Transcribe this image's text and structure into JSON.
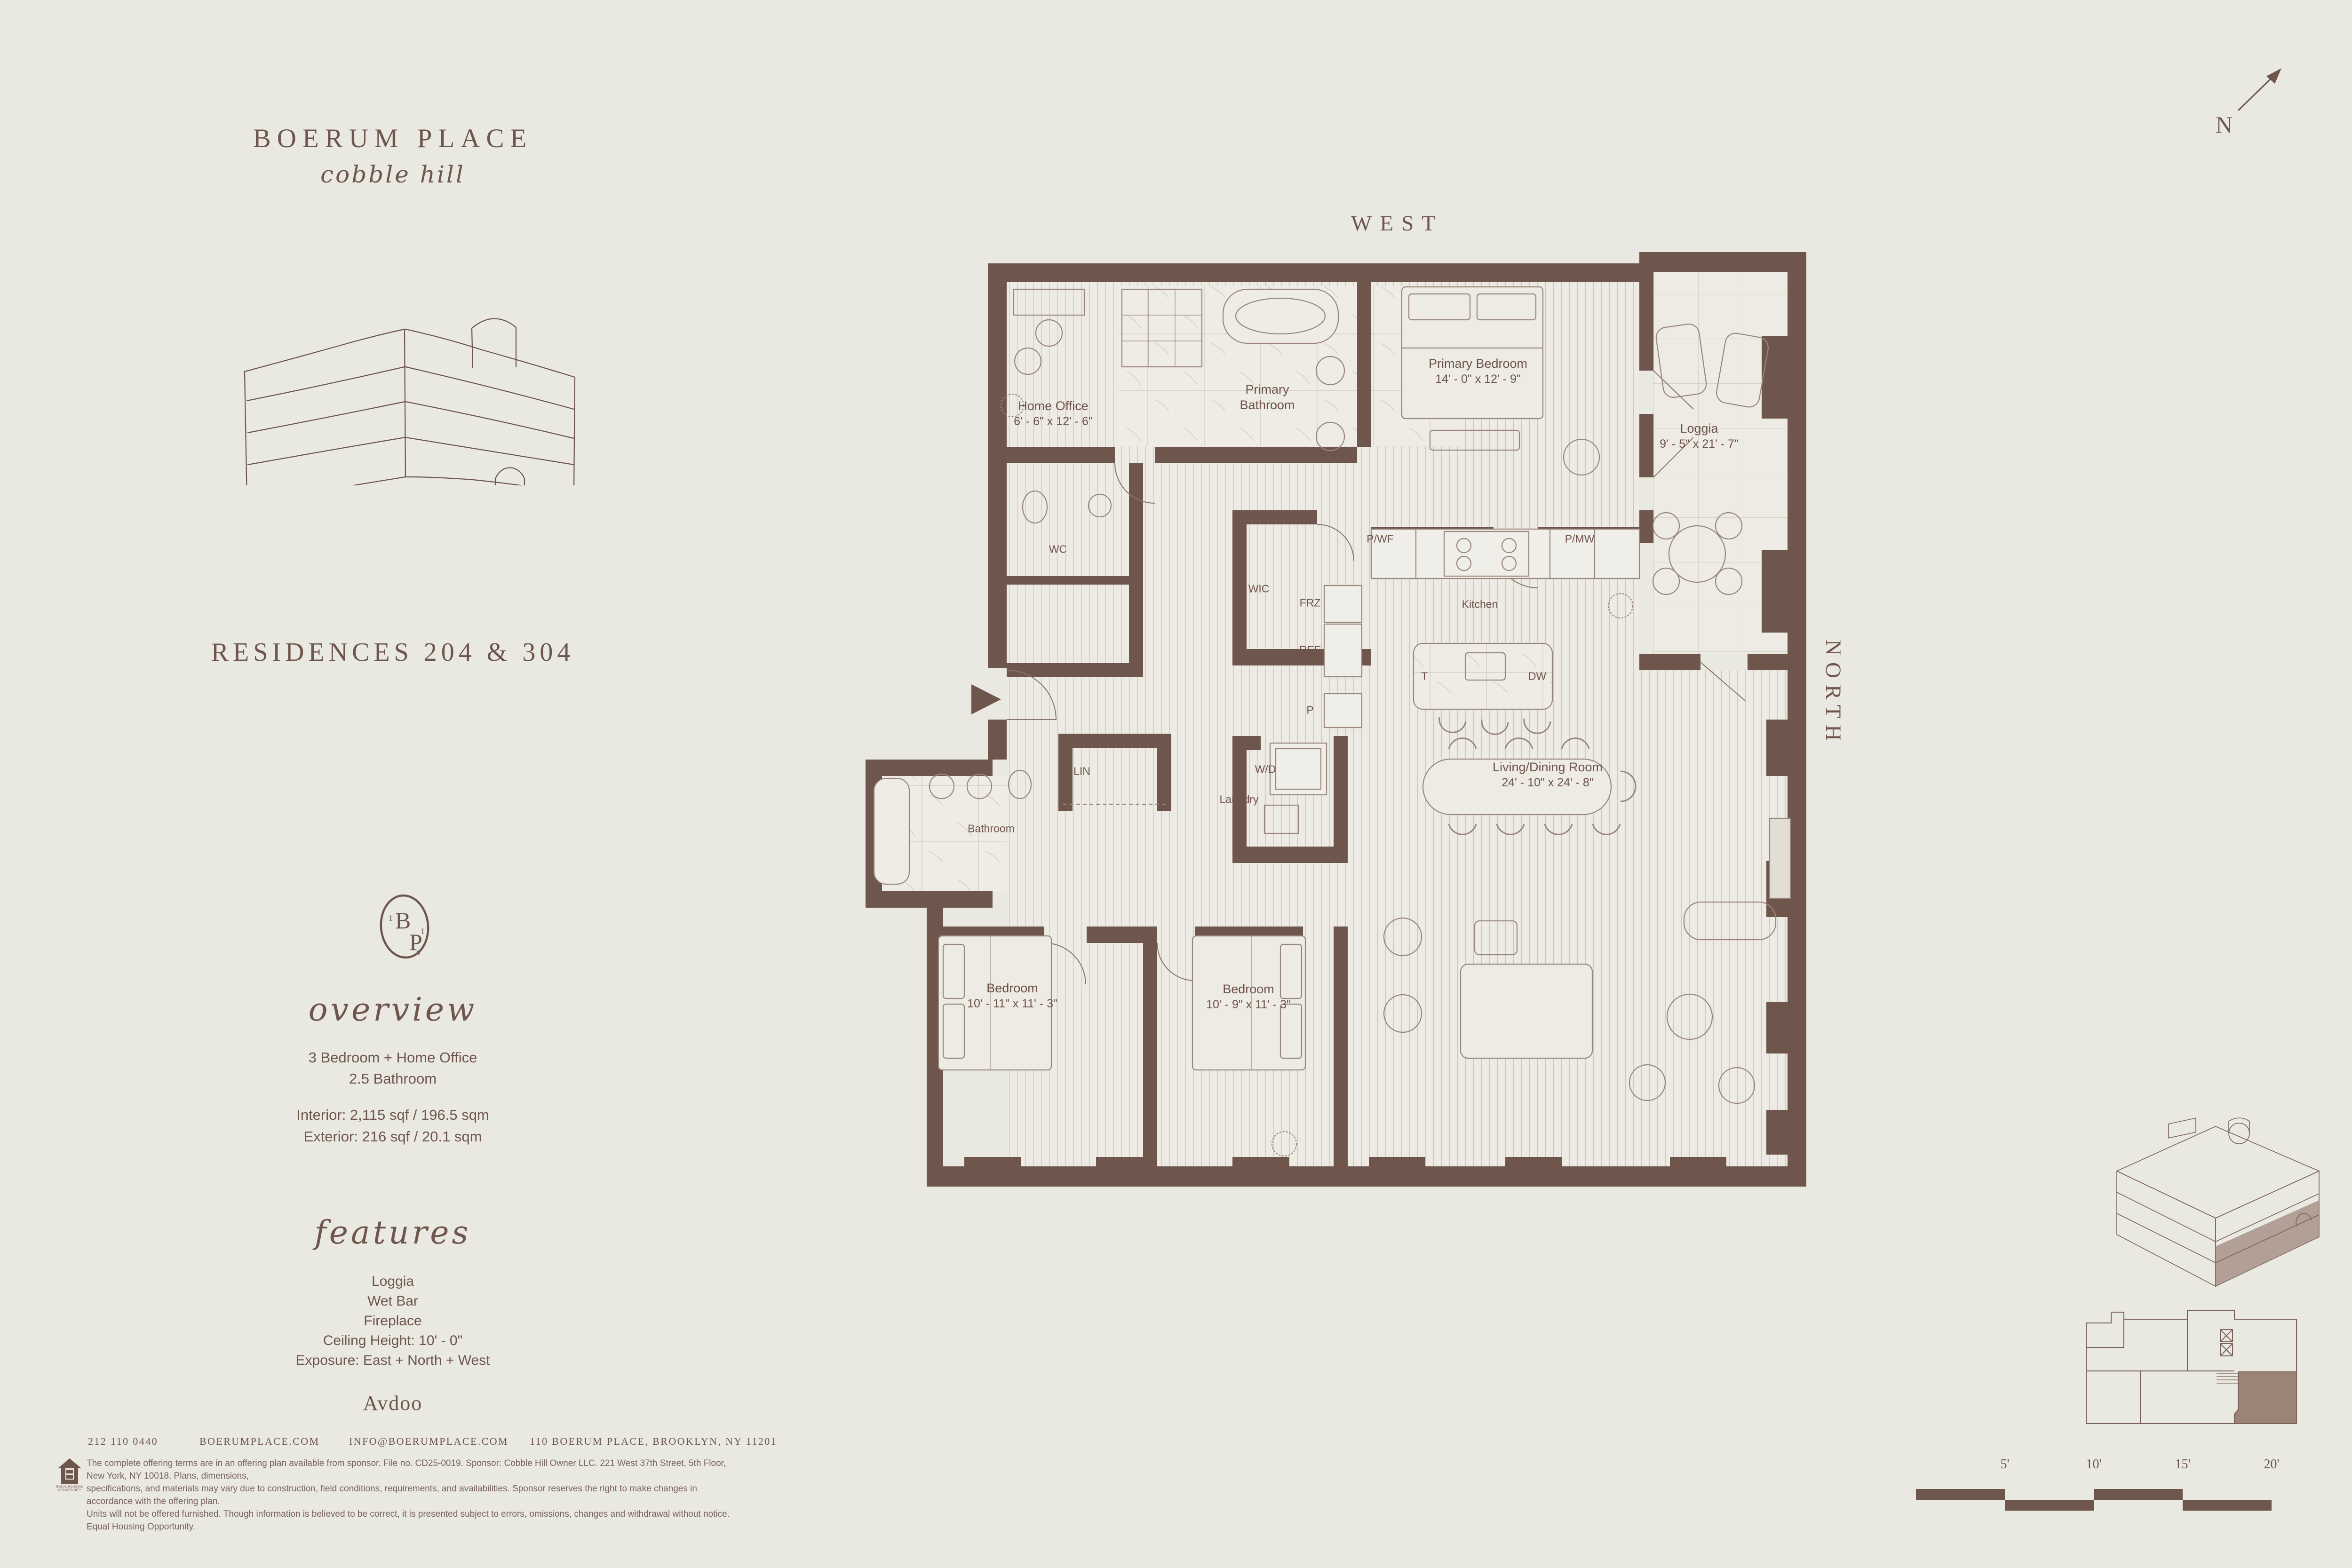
{
  "colors": {
    "background": "#e9e8e1",
    "ink": "#6f564c",
    "wall": "#6e564d",
    "shade": "#9c8378"
  },
  "brand": {
    "name": "BOERUM PLACE",
    "tagline": "cobble hill"
  },
  "monogram": {
    "b": "B",
    "p": "P",
    "d1": "1",
    "d2": "1",
    "d3": "0"
  },
  "residences": {
    "title": "RESIDENCES 204 & 304"
  },
  "overview": {
    "heading": "overview",
    "lines": [
      "3 Bedroom + Home Office",
      "2.5 Bathroom"
    ],
    "interior": "Interior: 2,115 sqf / 196.5 sqm",
    "exterior": "Exterior: 216 sqf / 20.1 sqm"
  },
  "features": {
    "heading": "features",
    "items": [
      "Loggia",
      "Wet Bar",
      "Fireplace",
      "Ceiling Height: 10' - 0\"",
      "Exposure: East + North + West"
    ]
  },
  "developer": {
    "name": "Avdoo"
  },
  "contact": {
    "phone": "212 110 0440",
    "website": "BOERUMPLACE.COM",
    "email": "INFO@BOERUMPLACE.COM",
    "address": "110 BOERUM PLACE, BROOKLYN, NY 11201"
  },
  "legal": {
    "equal_housing": "EQUAL HOUSING OPPORTUNITY",
    "disclaimer": [
      "The complete offering terms are in an offering plan available from sponsor. File no. CD25-0019. Sponsor: Cobble Hill Owner LLC. 221 West 37th Street, 5th Floor, New York, NY 10018. Plans, dimensions,",
      "specifications, and materials may vary due to construction, field conditions, requirements, and availabilities. Sponsor reserves the right to make changes in accordance with the offering plan.",
      "Units will not be offered furnished. Though information is believed to be correct, it is presented subject to errors, omissions, changes and withdrawal without notice. Equal Housing Opportunity."
    ]
  },
  "orientation": {
    "top": "WEST",
    "bottom": "EAST",
    "right": "NORTH"
  },
  "compass": {
    "label": "N"
  },
  "scale_bar": {
    "labels": [
      "5'",
      "10'",
      "15'",
      "20'"
    ]
  },
  "floor_plan": {
    "rooms": {
      "home_office": {
        "name": "Home Office",
        "dims": "6' - 6\" x 12' - 6\""
      },
      "primary_bathroom": {
        "name": "Primary Bathroom"
      },
      "primary_bedroom": {
        "name": "Primary Bedroom",
        "dims": "14' - 0\" x 12' - 9\""
      },
      "loggia": {
        "name": "Loggia",
        "dims": "9' - 5\" x 21' - 7\""
      },
      "wc": {
        "name": "WC"
      },
      "wic": {
        "name": "WIC"
      },
      "kitchen": {
        "name": "Kitchen"
      },
      "laundry": {
        "name": "Laundry"
      },
      "lin": {
        "name": "LIN"
      },
      "bathroom": {
        "name": "Bathroom"
      },
      "bedroom_1": {
        "name": "Bedroom",
        "dims": "10' - 11\" x 11' - 3\""
      },
      "bedroom_2": {
        "name": "Bedroom",
        "dims": "10' - 9\" x 11' - 3\""
      },
      "living_dining": {
        "name": "Living/Dining Room",
        "dims": "24' - 10\" x 24' - 8\""
      }
    },
    "fixtures": {
      "pwf": "P/WF",
      "pmw": "P/MW",
      "frz": "FRZ",
      "ref": "REF",
      "p": "P",
      "t": "T",
      "dw": "DW",
      "wd": "W/D"
    }
  }
}
